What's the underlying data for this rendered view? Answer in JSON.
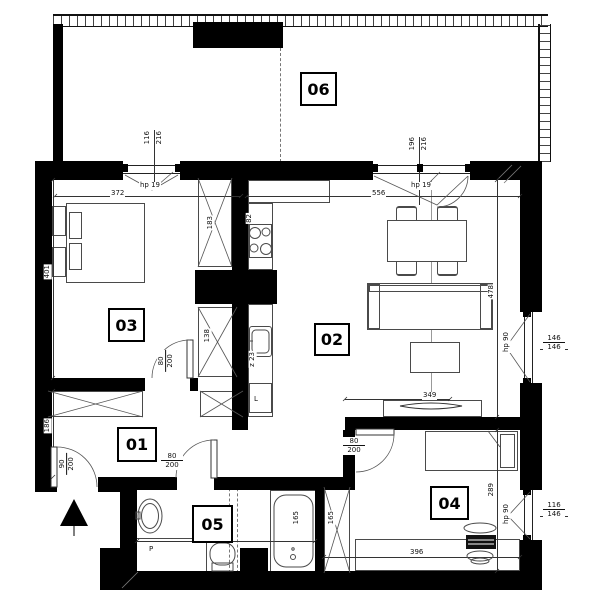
{
  "rooms": [
    {
      "n": "01"
    },
    {
      "n": "02"
    },
    {
      "n": "03"
    },
    {
      "n": "04"
    },
    {
      "n": "05"
    },
    {
      "n": "06"
    }
  ],
  "dims": {
    "d116": "116",
    "d216a": "216",
    "hp19a": "hp 19",
    "d372": "372",
    "d196": "196",
    "d216b": "216",
    "hp19b": "hp 19",
    "d556": "556",
    "d401": "401",
    "d186": "186",
    "d183": "183",
    "d138": "138",
    "d82": "82",
    "z23": "z 23",
    "fridge": "L",
    "washer": "P",
    "d478": "478",
    "d289": "289",
    "d349": "349",
    "d396": "396",
    "d368": "368",
    "d165tub": "165",
    "d165w": "165",
    "hp90a": "hp 90",
    "d146a": "146",
    "d146b": "146",
    "hp90b": "hp 90",
    "d116b": "116",
    "d146c": "146",
    "door_entry_w": "90",
    "door_entry_h": "200",
    "door03_w": "80",
    "door03_h": "200",
    "door05_w": "80",
    "door05_h": "200",
    "door04_w": "80",
    "door04_h": "200"
  },
  "colors": {
    "wall": "#000000",
    "line": "#4a4a4a",
    "background": "#ffffff"
  }
}
